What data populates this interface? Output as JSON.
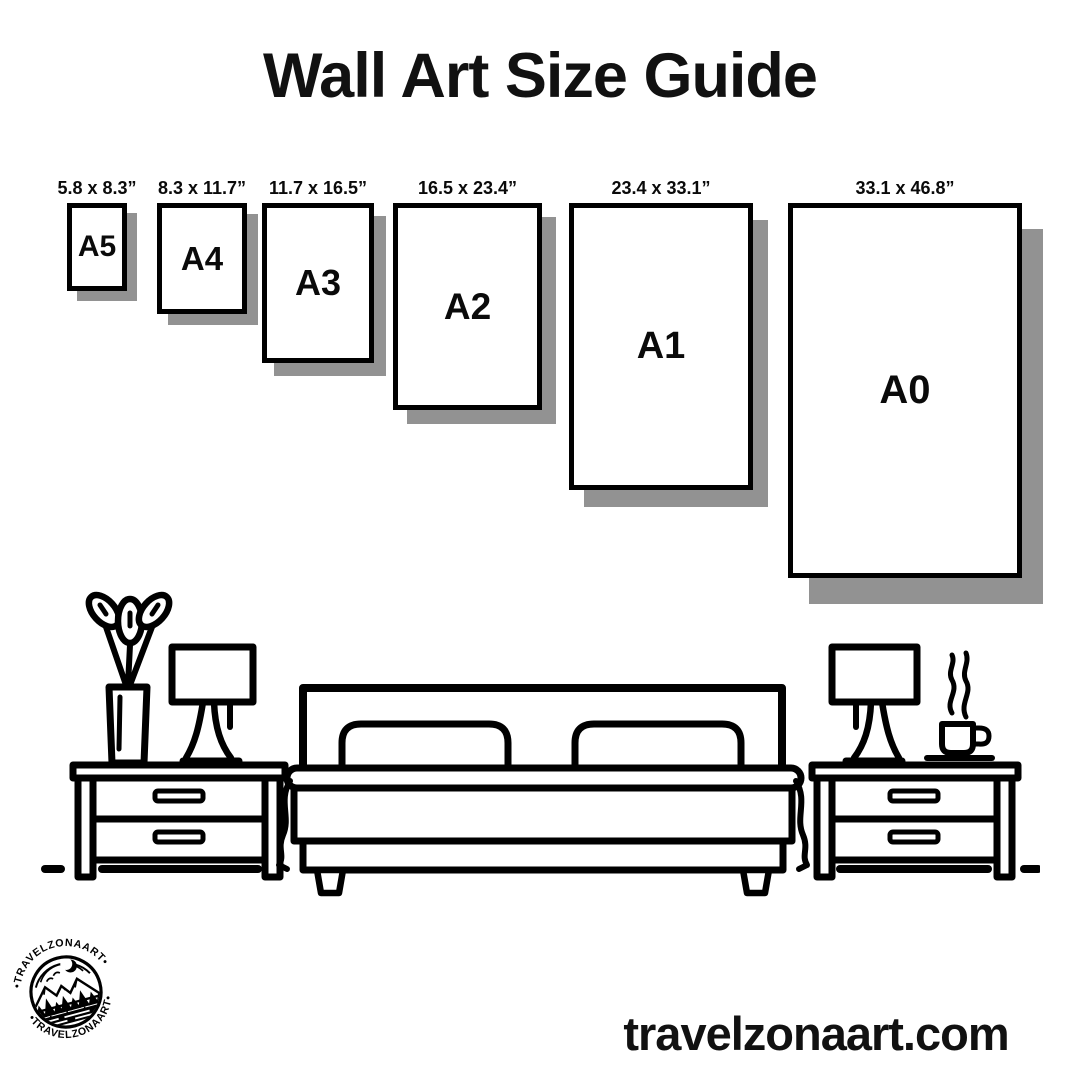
{
  "title": "Wall Art Size Guide",
  "sizes": {
    "items": [
      {
        "name": "A5",
        "dimensions": "5.8 x 8.3”"
      },
      {
        "name": "A4",
        "dimensions": "8.3 x 11.7”"
      },
      {
        "name": "A3",
        "dimensions": "11.7 x 16.5”"
      },
      {
        "name": "A2",
        "dimensions": "16.5 x 23.4”"
      },
      {
        "name": "A1",
        "dimensions": "23.4 x 33.1”"
      },
      {
        "name": "A0",
        "dimensions": "33.1 x 46.8”"
      }
    ]
  },
  "brand": {
    "website": "travelzonaart.com",
    "badge_text_top": "•TRAVELZONAART•",
    "badge_text_bottom": "•TRAVELZONAART•"
  },
  "colors": {
    "ink": "#0a0a0a",
    "paper": "#ffffff",
    "shadow": "#929292"
  },
  "illustration": {
    "icons": [
      "plant-vase-icon",
      "table-lamp-icon",
      "nightstand-icon",
      "double-bed-icon",
      "coffee-cup-icon",
      "logo-badge-icon"
    ]
  }
}
